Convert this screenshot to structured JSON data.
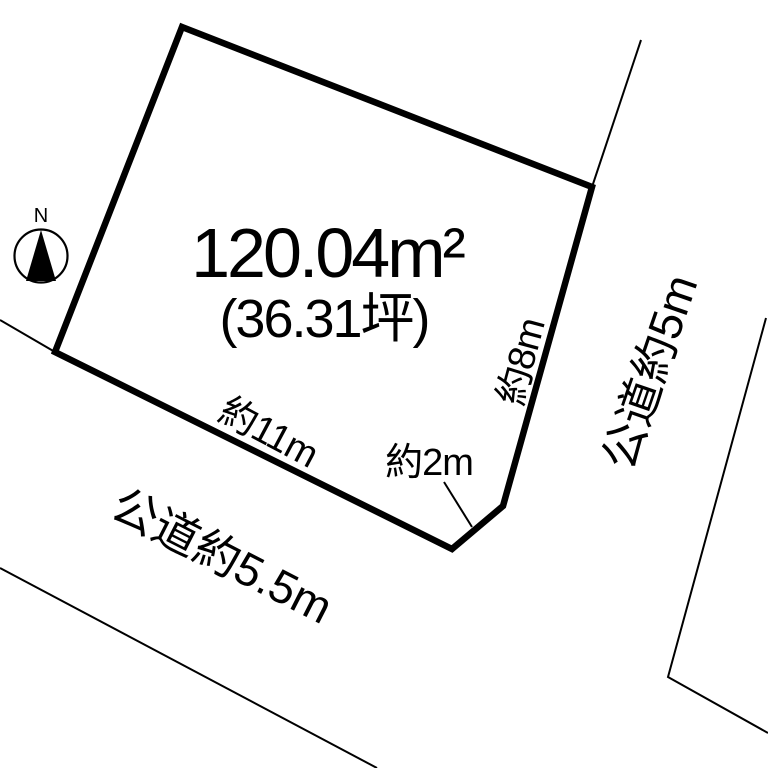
{
  "canvas": {
    "background": "#ffffff",
    "line_color": "#000000"
  },
  "compass": {
    "north_label": "N"
  },
  "parcel": {
    "area_m2": "120.04m²",
    "area_tsubo": "(36.31坪)",
    "dimensions": {
      "bottom_edge": "約11m",
      "corner_cut": "約2m",
      "right_edge": "約8m"
    }
  },
  "roads": {
    "bottom_road_label": "公道約5.5m",
    "right_road_label": "公道約5m"
  }
}
